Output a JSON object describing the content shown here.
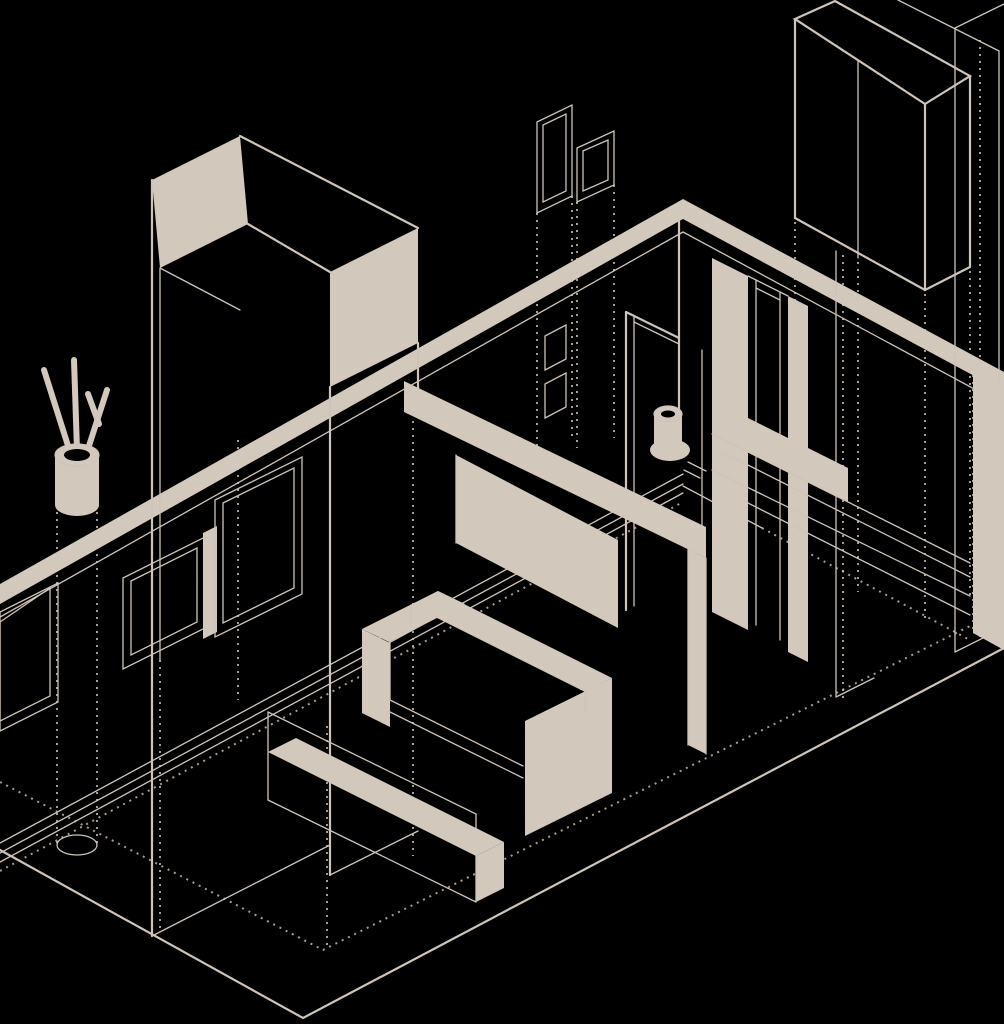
{
  "meta": {
    "title": "Isometric wireframe illustration of an apartment interior",
    "canvas_width": 1004,
    "canvas_height": 1024
  },
  "palette": {
    "background": "#000000",
    "line": "#cfc4b9",
    "fill": "#d3c8bc"
  },
  "scene": {
    "style": "single-color isometric line art, beige on black, cutaway room view",
    "objects": [
      {
        "id": "floor",
        "label": "Room floor outline with hidden dashed edges"
      },
      {
        "id": "back-walls",
        "label": "Back wall top band meeting at corner apex"
      },
      {
        "id": "window-frames",
        "label": "Window frames on back-left wall"
      },
      {
        "id": "entry-wall-unit",
        "label": "Tall entry wall unit with solid top and end face"
      },
      {
        "id": "floor-vase",
        "label": "Tall floor vase with branch sticks"
      },
      {
        "id": "glass-partition-columns",
        "label": "Tall thin glazed panels with wall switches"
      },
      {
        "id": "wardrobe",
        "label": "Wireframe two-door wardrobe"
      },
      {
        "id": "right-cabinet",
        "label": "Tall cabinet at right edge"
      },
      {
        "id": "bathroom-wall",
        "label": "Right wall with door openings, piers and counter"
      },
      {
        "id": "toilet",
        "label": "Toilet fixture"
      },
      {
        "id": "tv-partition",
        "label": "Half-height TV partition wall"
      },
      {
        "id": "tv-panel",
        "label": "Wall-mounted TV panel"
      },
      {
        "id": "sofa",
        "label": "L-shaped sofa with solid back band"
      },
      {
        "id": "coffee-table",
        "label": "Low coffee table bench"
      }
    ]
  }
}
